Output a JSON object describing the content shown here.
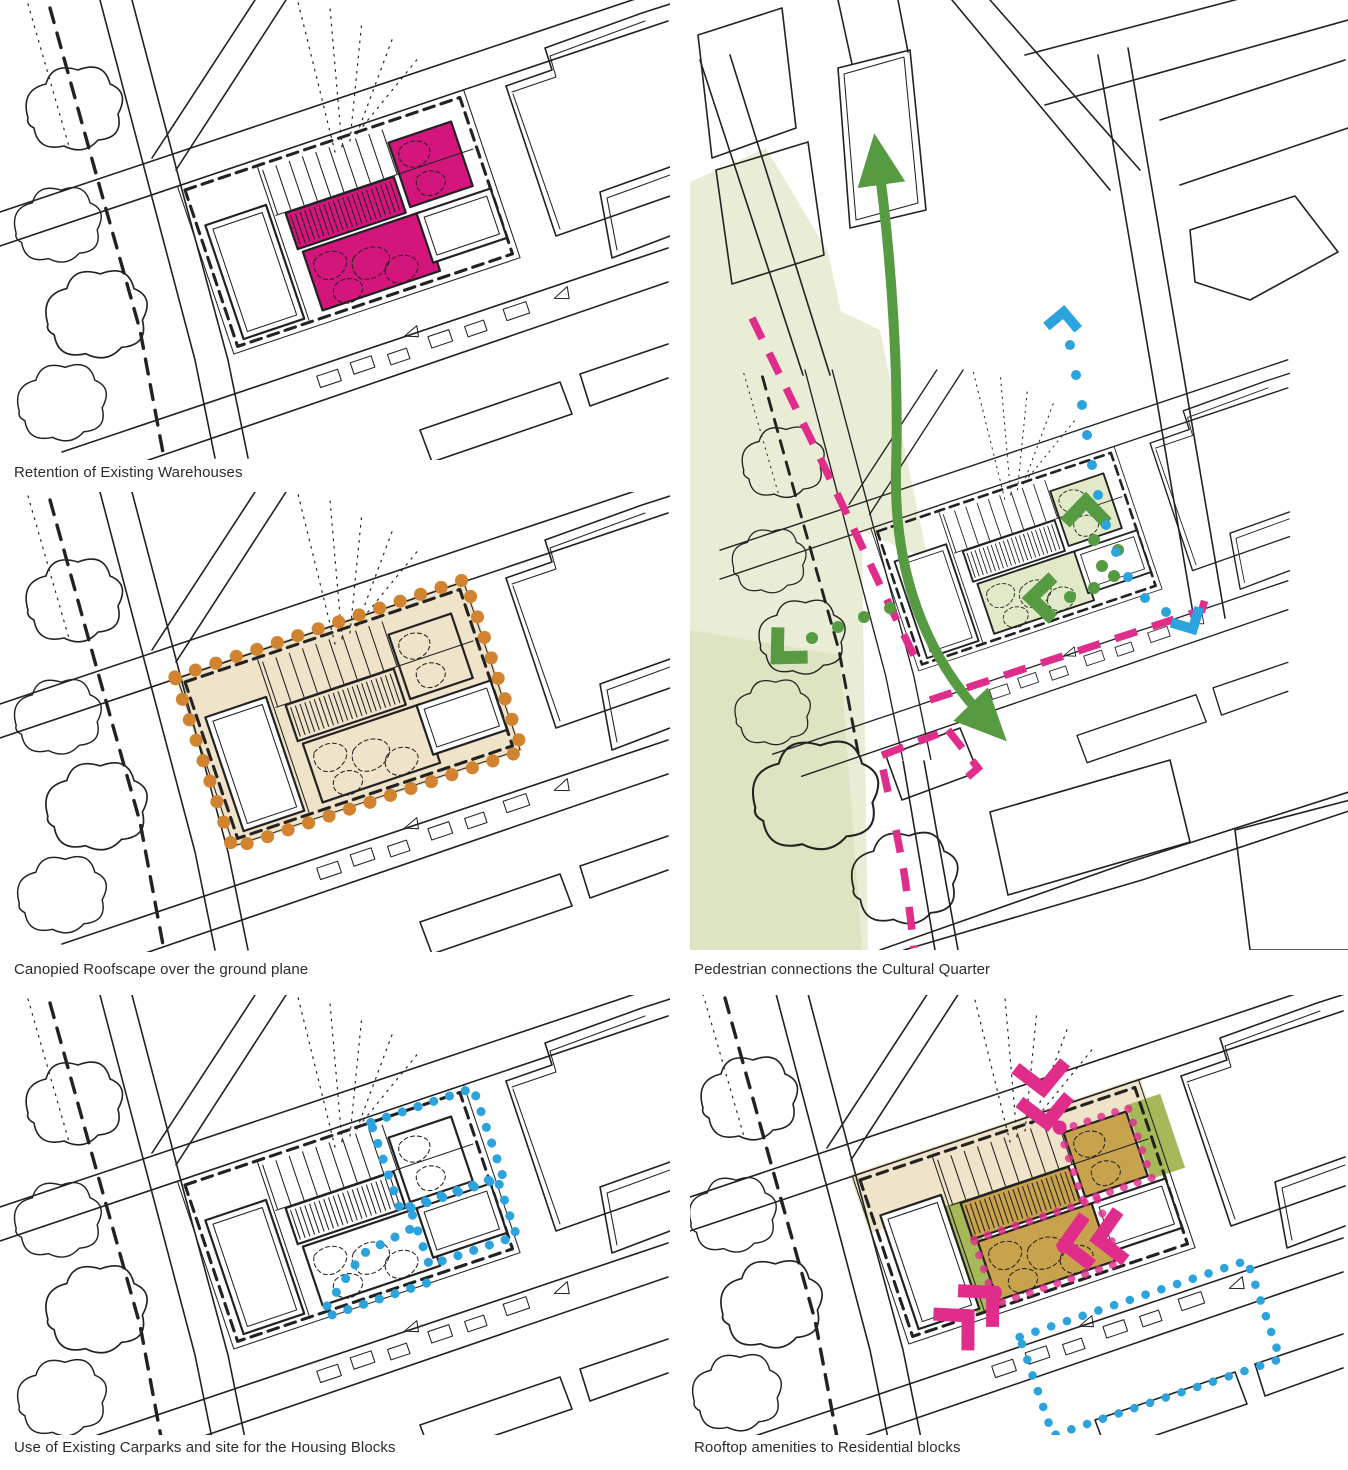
{
  "document": {
    "type": "architectural concept diagram sheet",
    "background": "#ffffff",
    "layout": "two columns, five sketch panels of the same city block"
  },
  "palette": {
    "ink": "#222222",
    "magenta": "#D4157C",
    "pink": "#E02D8C",
    "orange": "#D1832F",
    "tan": "#EFE4C9",
    "olive": "#A5B958",
    "ochre": "#C9A24D",
    "blue": "#2CA3DC",
    "green": "#569B41",
    "wash": "#E9EDD6",
    "tint": "#E2E9C9",
    "wash_dark": "#DDE4C1",
    "caption": "#2B2B2B"
  },
  "panels": [
    {
      "id": "retention",
      "caption": "Retention of Existing Warehouses",
      "highlight": "retained warehouse roofs filled magenta"
    },
    {
      "id": "canopy",
      "caption": "Canopied Roofscape over the ground plane",
      "highlight": "site block shaded tan with orange dotted canopy boundary"
    },
    {
      "id": "pedestrian",
      "caption": "Pedestrian connections the Cultural Quarter",
      "highlight": "green movement arrows and dotted trails, pink dashed routes, blue dotted route, green landscape wash"
    },
    {
      "id": "carparks",
      "caption": "Use of Existing Carparks and site for the Housing Blocks",
      "highlight": "existing carpark structures filled blue, blue dotted outlines for housing blocks"
    },
    {
      "id": "rooftop",
      "caption": "Rooftop amenities to Residential blocks",
      "highlight": "olive and ochre rooftop terraces, pink access chevrons and dots, blue dotted block outline"
    }
  ]
}
